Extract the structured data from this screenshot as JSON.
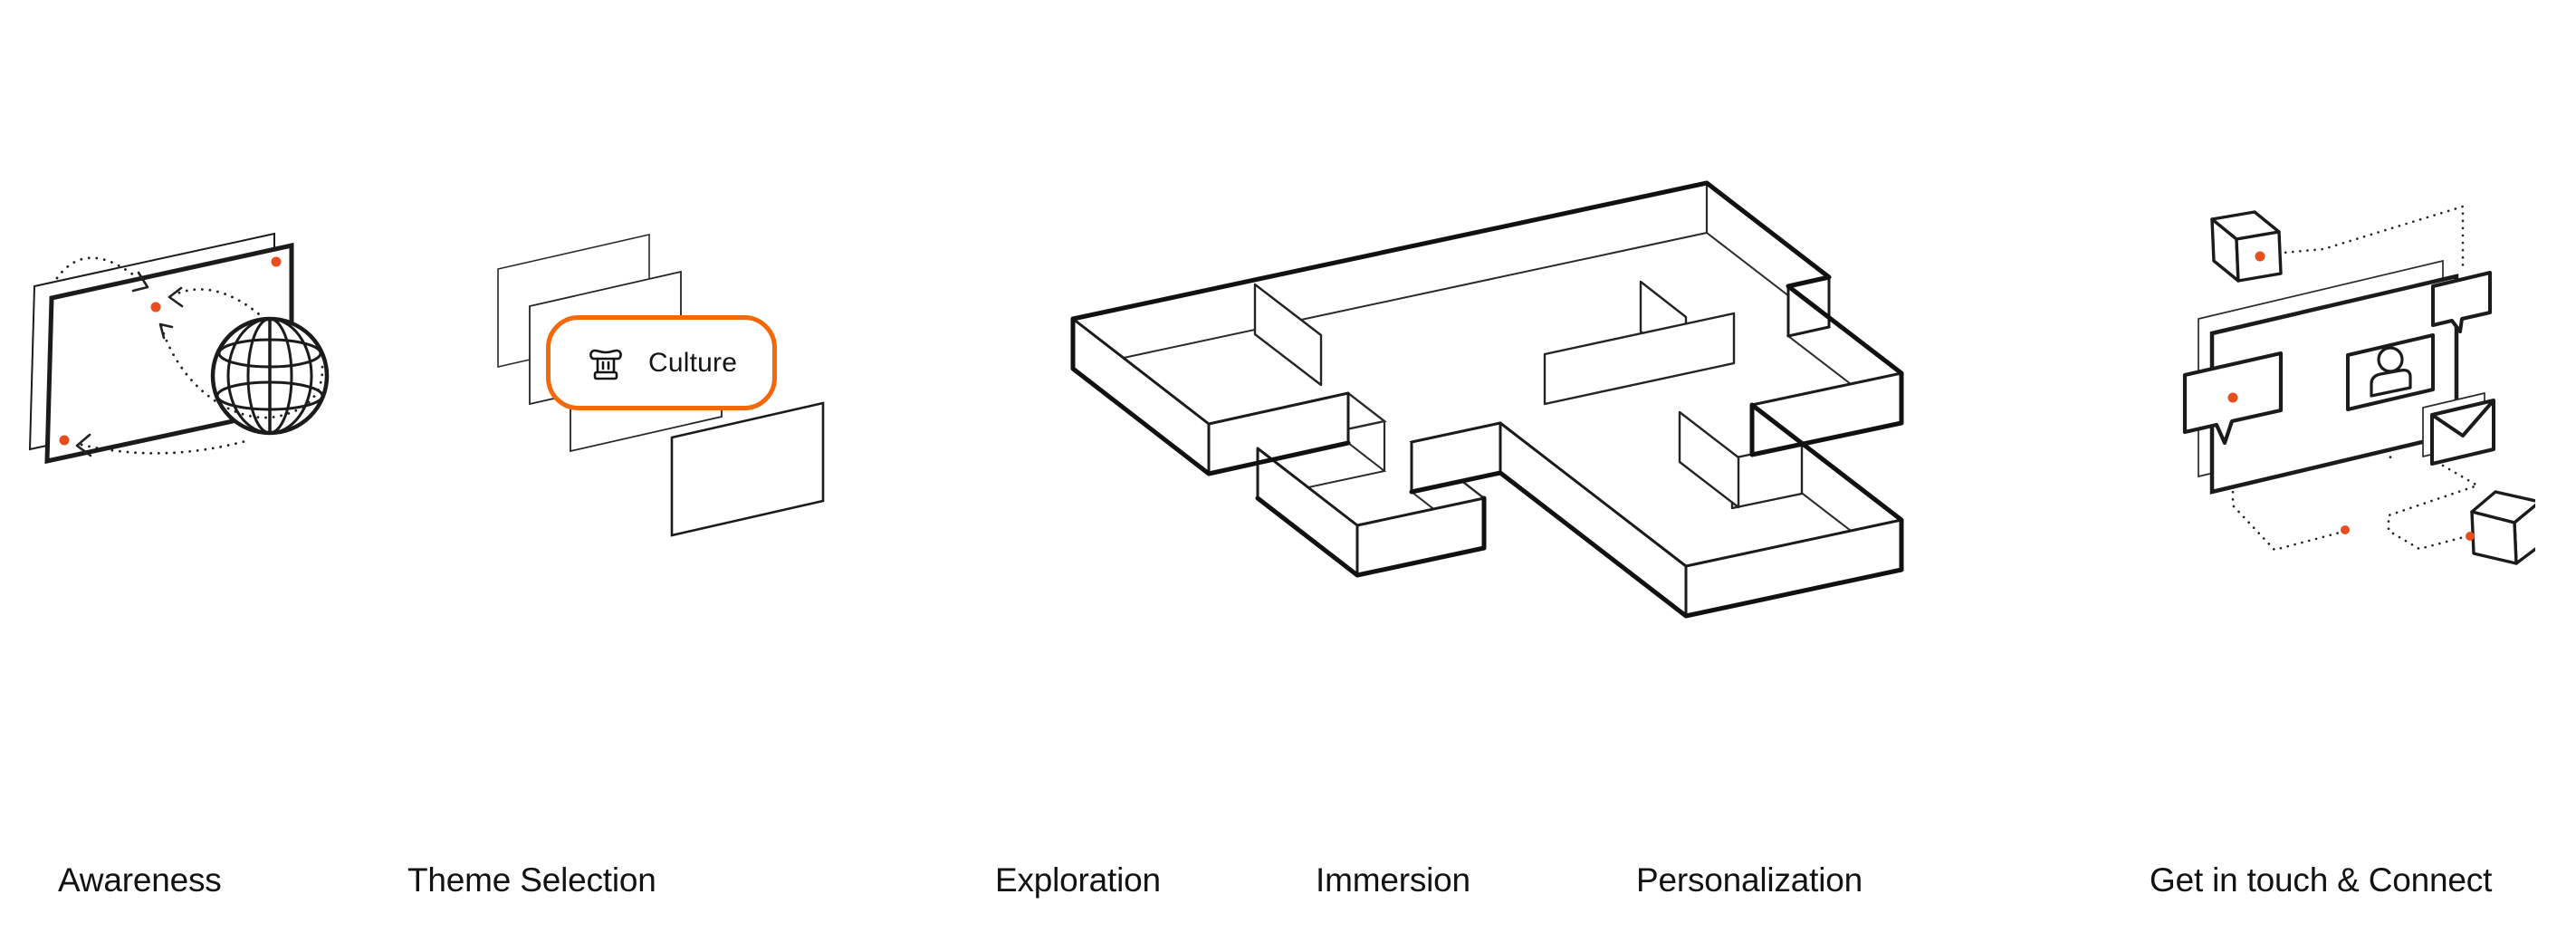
{
  "page": {
    "background": "#ffffff"
  },
  "colors": {
    "line_black": "#1b1b1b",
    "accent_orange_border": "#F5680A",
    "accent_orange_dot": "#E84E1B"
  },
  "journey": {
    "steps": [
      {
        "label": "Awareness",
        "illustration": "screens-globe-icon"
      },
      {
        "label": "Theme Selection",
        "illustration": "layered-cards-icon"
      },
      {
        "label": "Exploration",
        "illustration": "isometric-maze-icon"
      },
      {
        "label": "Immersion",
        "illustration": "isometric-maze-icon"
      },
      {
        "label": "Personalization",
        "illustration": "isometric-maze-icon"
      },
      {
        "label": "Get in touch & Connect",
        "illustration": "screens-chat-mail-cubes-icon"
      }
    ],
    "theme_tag": {
      "label": "Culture",
      "icon": "museum-column-icon"
    }
  }
}
